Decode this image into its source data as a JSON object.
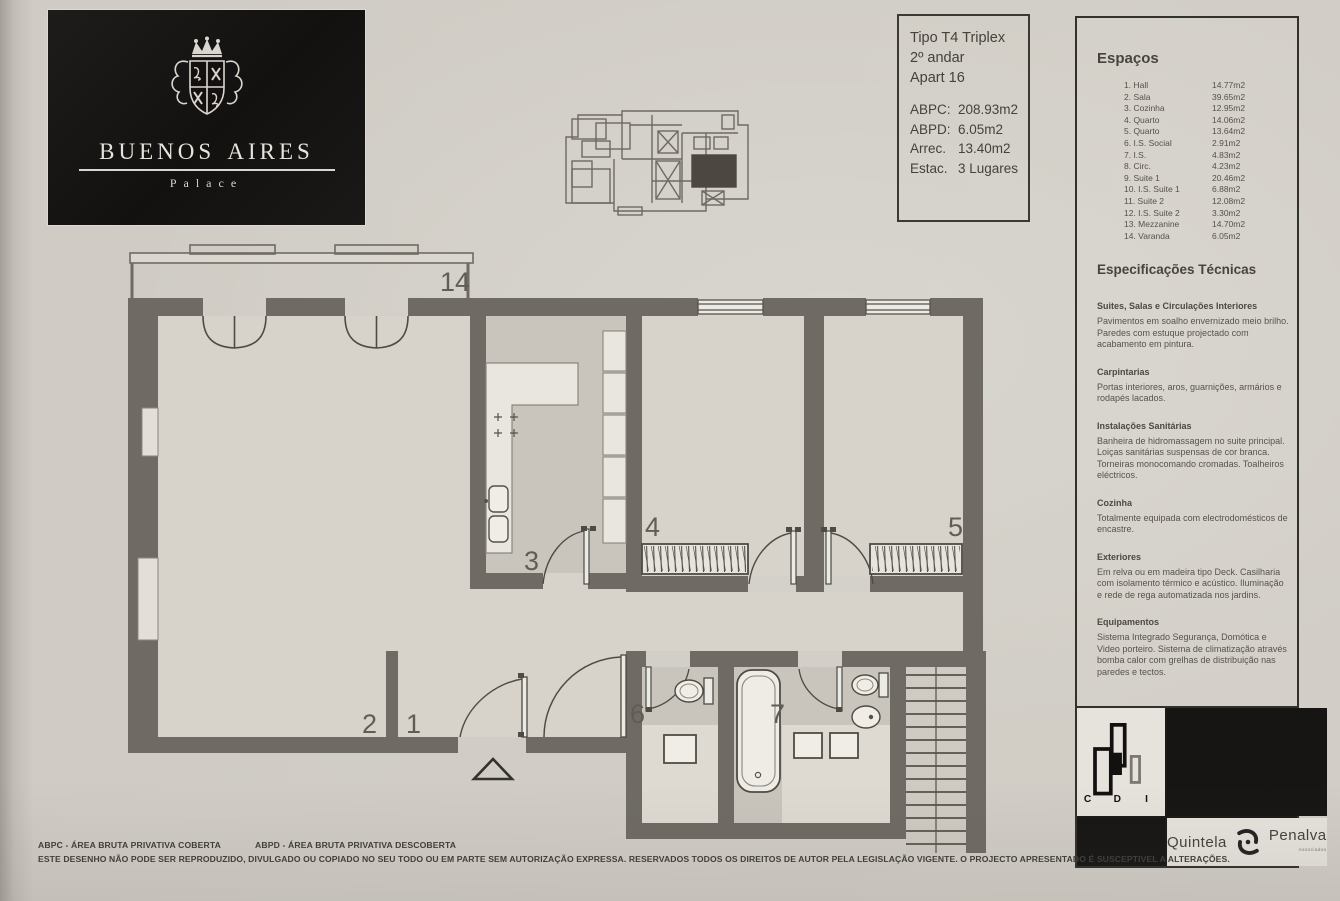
{
  "brand": {
    "name": "Buenos Aires",
    "subtitle": "Palace"
  },
  "info_box": {
    "type": "Tipo T4 Triplex",
    "floor": "2º andar",
    "apartment": "Apart 16",
    "metrics": [
      {
        "label": "ABPC:",
        "value": "208.93m2"
      },
      {
        "label": "ABPD:",
        "value": "6.05m2"
      },
      {
        "label": "Arrec.",
        "value": "13.40m2"
      },
      {
        "label": "Estac.",
        "value": "3 Lugares"
      }
    ]
  },
  "spaces": {
    "title": "Espaços",
    "items": [
      {
        "name": "1. Hall",
        "area": "14.77m2"
      },
      {
        "name": "2. Sala",
        "area": "39.65m2"
      },
      {
        "name": "3. Cozinha",
        "area": "12.95m2"
      },
      {
        "name": "4. Quarto",
        "area": "14.06m2"
      },
      {
        "name": "5. Quarto",
        "area": "13.64m2"
      },
      {
        "name": "6. I.S. Social",
        "area": "2.91m2"
      },
      {
        "name": "7. I.S.",
        "area": "4.83m2"
      },
      {
        "name": "8. Circ.",
        "area": "4.23m2"
      },
      {
        "name": "9. Suite 1",
        "area": "20.46m2"
      },
      {
        "name": "10. I.S. Suite 1",
        "area": "6.88m2"
      },
      {
        "name": "11. Suite 2",
        "area": "12.08m2"
      },
      {
        "name": "12. I.S. Suite 2",
        "area": "3.30m2"
      },
      {
        "name": "13. Mezzanine",
        "area": "14.70m2"
      },
      {
        "name": "14. Varanda",
        "area": "6.05m2"
      }
    ]
  },
  "specs": {
    "title": "Especificações Técnicas",
    "sections": [
      {
        "heading": "Suites, Salas e Circulações Interiores",
        "body": "Pavimentos em soalho envernizado meio brilho. Paredes com estuque projectado com acabamento em pintura."
      },
      {
        "heading": "Carpintarias",
        "body": "Portas interiores, aros, guarnições, armários e rodapés lacados."
      },
      {
        "heading": "Instalações Sanitárias",
        "body": "Banheira de hidromassagem no suite principal. Loiças sanitárias suspensas de cor branca. Torneiras monocomando cromadas. Toalheiros eléctricos."
      },
      {
        "heading": "Cozinha",
        "body": "Totalmente equipada com electrodomésticos de encastre."
      },
      {
        "heading": "Exteriores",
        "body": "Em relva ou em madeira tipo Deck. Casilharia com isolamento térmico e acústico. Iluminação e rede de rega automatizada nos jardins."
      },
      {
        "heading": "Equipamentos",
        "body": "Sistema Integrado Segurança, Domótica e Video porteiro. Sistema de climatização através bomba calor com grelhas de distribuição nas paredes e tectos."
      }
    ]
  },
  "plan": {
    "labels": {
      "balcony": "14",
      "hall": "1",
      "sala": "2",
      "cozinha": "3",
      "quarto_4": "4",
      "quarto_5": "5",
      "is_social": "6",
      "is_7": "7"
    }
  },
  "partners": {
    "cdi": {
      "c": "C",
      "d": "D",
      "i": "I"
    },
    "quintela": "Quintela",
    "penalva": "Penalva",
    "associados": "Associados"
  },
  "footer": {
    "legend_abpc": "ABPC - ÁREA BRUTA PRIVATIVA COBERTA",
    "legend_abpd": "ABPD - ÁREA BRUTA PRIVATIVA DESCOBERTA",
    "disclaimer": "ESTE DESENHO NÃO PODE SER REPRODUZIDO, DIVULGADO OU COPIADO NO SEU TODO OU EM PARTE SEM AUTORIZAÇÃO EXPRESSA. RESERVADOS TODOS OS DIREITOS DE AUTOR PELA LEGISLAÇÃO VIGENTE. O PROJECTO APRESENTADO É SUSCEPTIVEL A ALTERAÇÕES."
  },
  "colors": {
    "paper": "#d0ccc5",
    "wall": "#6f6b64",
    "floor": "#d7d3cb",
    "service_floor": "#c9c5bd",
    "brand_black": "#141312",
    "line": "#55524b"
  }
}
